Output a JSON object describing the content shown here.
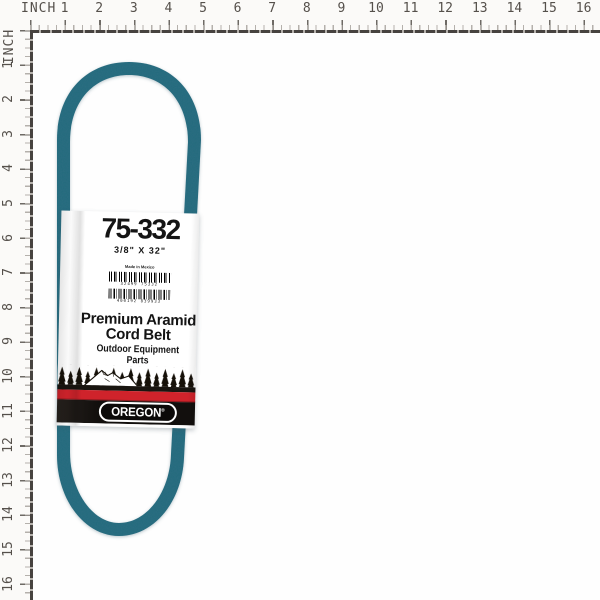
{
  "ruler": {
    "unit_label": "INCH",
    "numbers": [
      1,
      2,
      3,
      4,
      5,
      6,
      7,
      8,
      9,
      10,
      11,
      12,
      13,
      14,
      15,
      16
    ],
    "pixels_per_inch": 34.6,
    "origin_px": 30
  },
  "belt": {
    "description": "teal aramid v-belt loop",
    "color": "#2e6e82"
  },
  "label": {
    "part_number": "75-332",
    "size": "3/8\" X 32\"",
    "made_in": "Made in Mexico",
    "barcode_upper_digits": "32499  75332",
    "barcode_lower_digits": "400192  839933",
    "product_line1": "Premium Aramid",
    "product_line2": "Cord Belt",
    "product_line3": "Outdoor Equipment Parts",
    "brand": "OREGON",
    "reg_mark": "®",
    "colors": {
      "red_stripe": "#cf232b",
      "black_stripe": "#191510",
      "logo_background": "#120f0d",
      "belt_teal": "#2e6e82"
    }
  }
}
